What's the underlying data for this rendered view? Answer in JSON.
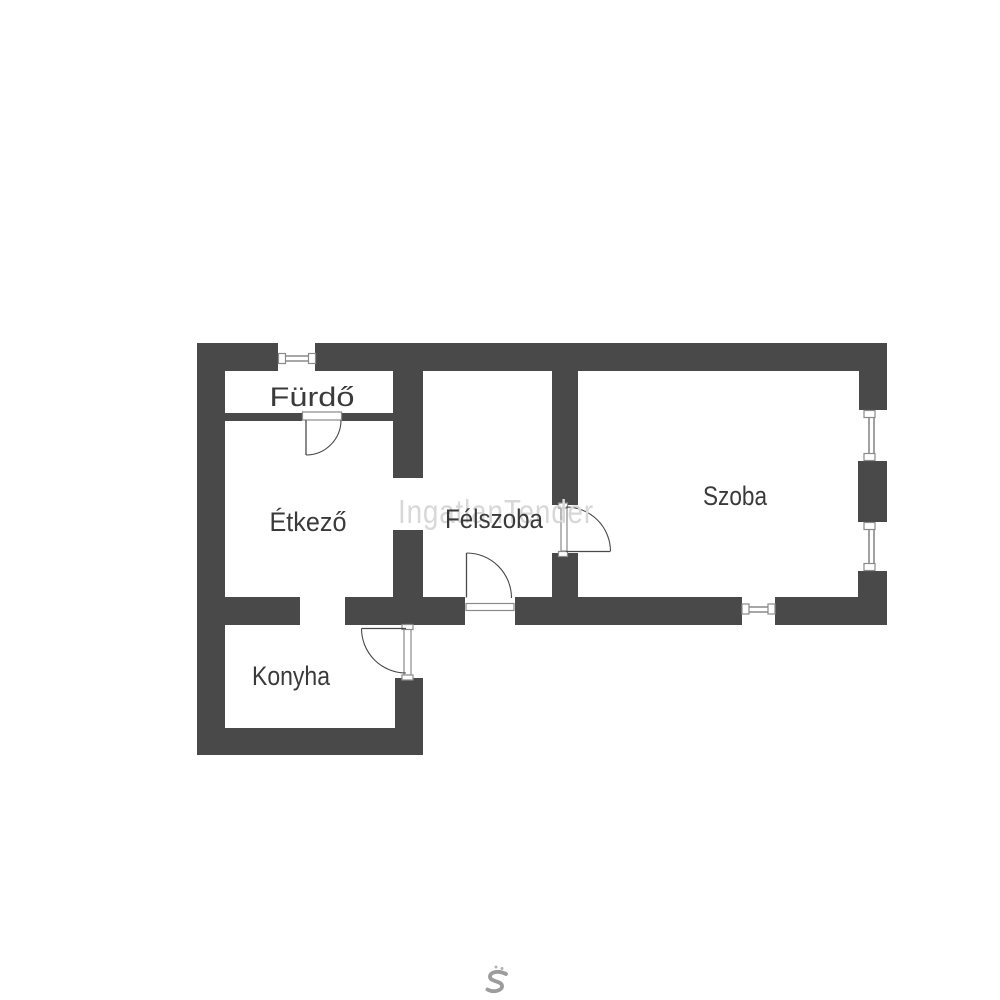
{
  "watermark": {
    "text": "IngatlanTender"
  },
  "rooms": [
    {
      "id": "furdo",
      "label": "Fürdő"
    },
    {
      "id": "etkezo",
      "label": "Étkező"
    },
    {
      "id": "felszoba",
      "label": "Félszoba"
    },
    {
      "id": "szoba",
      "label": "Szoba"
    },
    {
      "id": "konyha",
      "label": "Konyha"
    }
  ],
  "brand": {
    "logo": "ingatlantender-mark"
  },
  "theme": {
    "wall_color": "#494949",
    "label_color": "#3a3a3a",
    "watermark_color": "#d8d8d8",
    "frame_color": "#8a8a8a",
    "arc_color": "#4a4a4a",
    "bg_color": "#ffffff",
    "logo_color": "#9c9c9c",
    "logo_dot_color": "#b3b3b3"
  }
}
